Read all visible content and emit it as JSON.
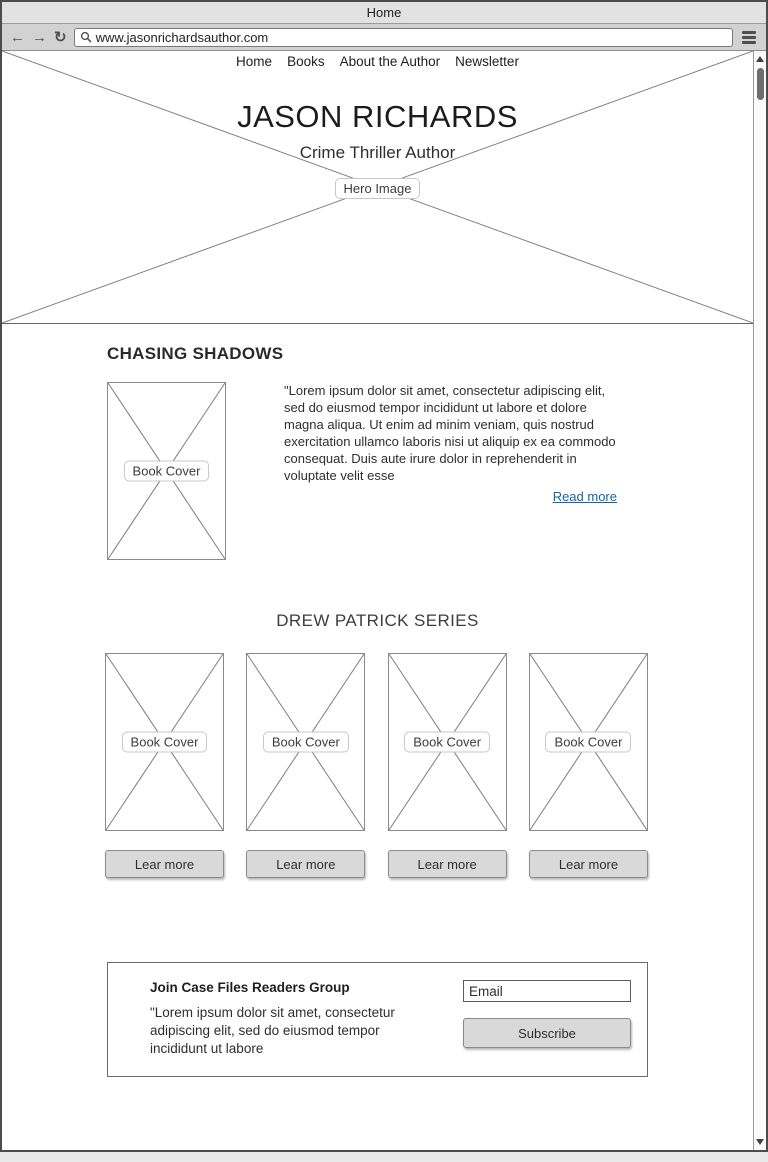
{
  "window": {
    "title": "Home"
  },
  "browser": {
    "back_icon": "←",
    "forward_icon": "→",
    "refresh_icon": "↻",
    "url": "www.jasonrichardsauthor.com"
  },
  "nav": {
    "items": [
      {
        "label": "Home"
      },
      {
        "label": "Books"
      },
      {
        "label": "About the Author"
      },
      {
        "label": "Newsletter"
      }
    ]
  },
  "hero": {
    "title": "JASON RICHARDS",
    "subtitle": "Crime Thriller Author",
    "placeholder_label": "Hero Image"
  },
  "featured": {
    "heading": "CHASING SHADOWS",
    "cover_label": "Book Cover",
    "excerpt": "\"Lorem ipsum dolor sit amet, consectetur adipiscing elit, sed do eiusmod tempor incididunt ut labore et dolore magna aliqua. Ut enim ad minim veniam, quis nostrud exercitation ullamco laboris nisi ut aliquip ex ea commodo consequat. Duis aute irure dolor in reprehenderit in voluptate velit esse",
    "read_more_label": "Read more"
  },
  "series": {
    "heading": "DREW PATRICK SERIES",
    "books": [
      {
        "cover_label": "Book Cover",
        "button_label": "Lear more"
      },
      {
        "cover_label": "Book Cover",
        "button_label": "Lear more"
      },
      {
        "cover_label": "Book Cover",
        "button_label": "Lear more"
      },
      {
        "cover_label": "Book Cover",
        "button_label": "Lear more"
      }
    ]
  },
  "newsletter": {
    "heading": "Join Case Files Readers Group",
    "text": "\"Lorem ipsum dolor sit amet, consectetur adipiscing elit, sed do eiusmod tempor incididunt ut labore",
    "email_value": "Email",
    "subscribe_label": "Subscribe"
  },
  "colors": {
    "link": "#1565a7",
    "button_bg": "#d9d9d9",
    "chrome_bg": "#d2d2d2",
    "titlebar_bg": "#e2e2e2",
    "window_border": "#4c4c4c",
    "placeholder_line": "#7d7d7d"
  }
}
